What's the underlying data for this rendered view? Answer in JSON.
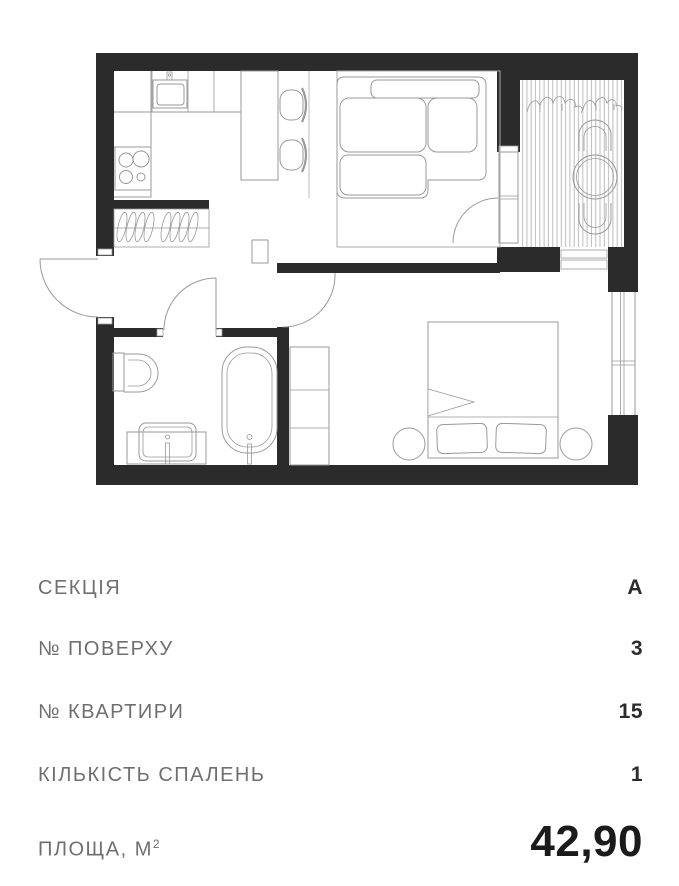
{
  "apartment_card": {
    "details": [
      {
        "label": "СЕКЦІЯ",
        "value": "А"
      },
      {
        "label": "№ ПОВЕРХУ",
        "value": "3"
      },
      {
        "label": "№ КВАРТИРИ",
        "value": "15"
      },
      {
        "label": "КІЛЬКІСТЬ СПАЛЕНЬ",
        "value": "1"
      },
      {
        "label": "ПЛОЩА, М",
        "label_superscript": "2",
        "value": "42,90"
      }
    ]
  },
  "floorplan": {
    "type": "apartment-floor-plan",
    "rooms": [
      "kitchen-living-room",
      "balcony",
      "hallway",
      "bathroom",
      "bedroom"
    ],
    "furniture": [
      "kitchen-counter",
      "kitchen-sink",
      "stove",
      "coat-hangers",
      "dining-table",
      "dining-chairs",
      "sofa",
      "rug",
      "toilet",
      "vanity-sink",
      "bathtub",
      "wardrobe",
      "shoe-cabinet",
      "double-bed",
      "pillows",
      "nightstands",
      "balcony-deck",
      "plants",
      "balcony-table",
      "balcony-chairs",
      "windows",
      "door-swings"
    ],
    "colors": {
      "walls": "#2b2b2b",
      "furniture_lines": "#999999",
      "background": "#ffffff"
    }
  },
  "colors": {
    "label_text": "#6f6f6f",
    "value_text": "#2b2b2b",
    "area_text": "#1b1b1b"
  }
}
